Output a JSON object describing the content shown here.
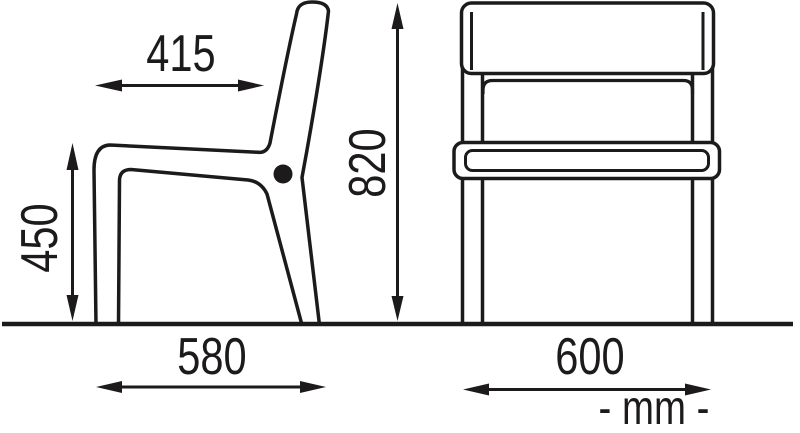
{
  "diagram": {
    "background_color": "#ffffff",
    "line_color": "#1d1a1b",
    "labels": {
      "seat_depth": "415",
      "seat_height": "450",
      "overall_height": "820",
      "overall_depth": "580",
      "overall_width": "600",
      "units": "- mm -"
    }
  }
}
